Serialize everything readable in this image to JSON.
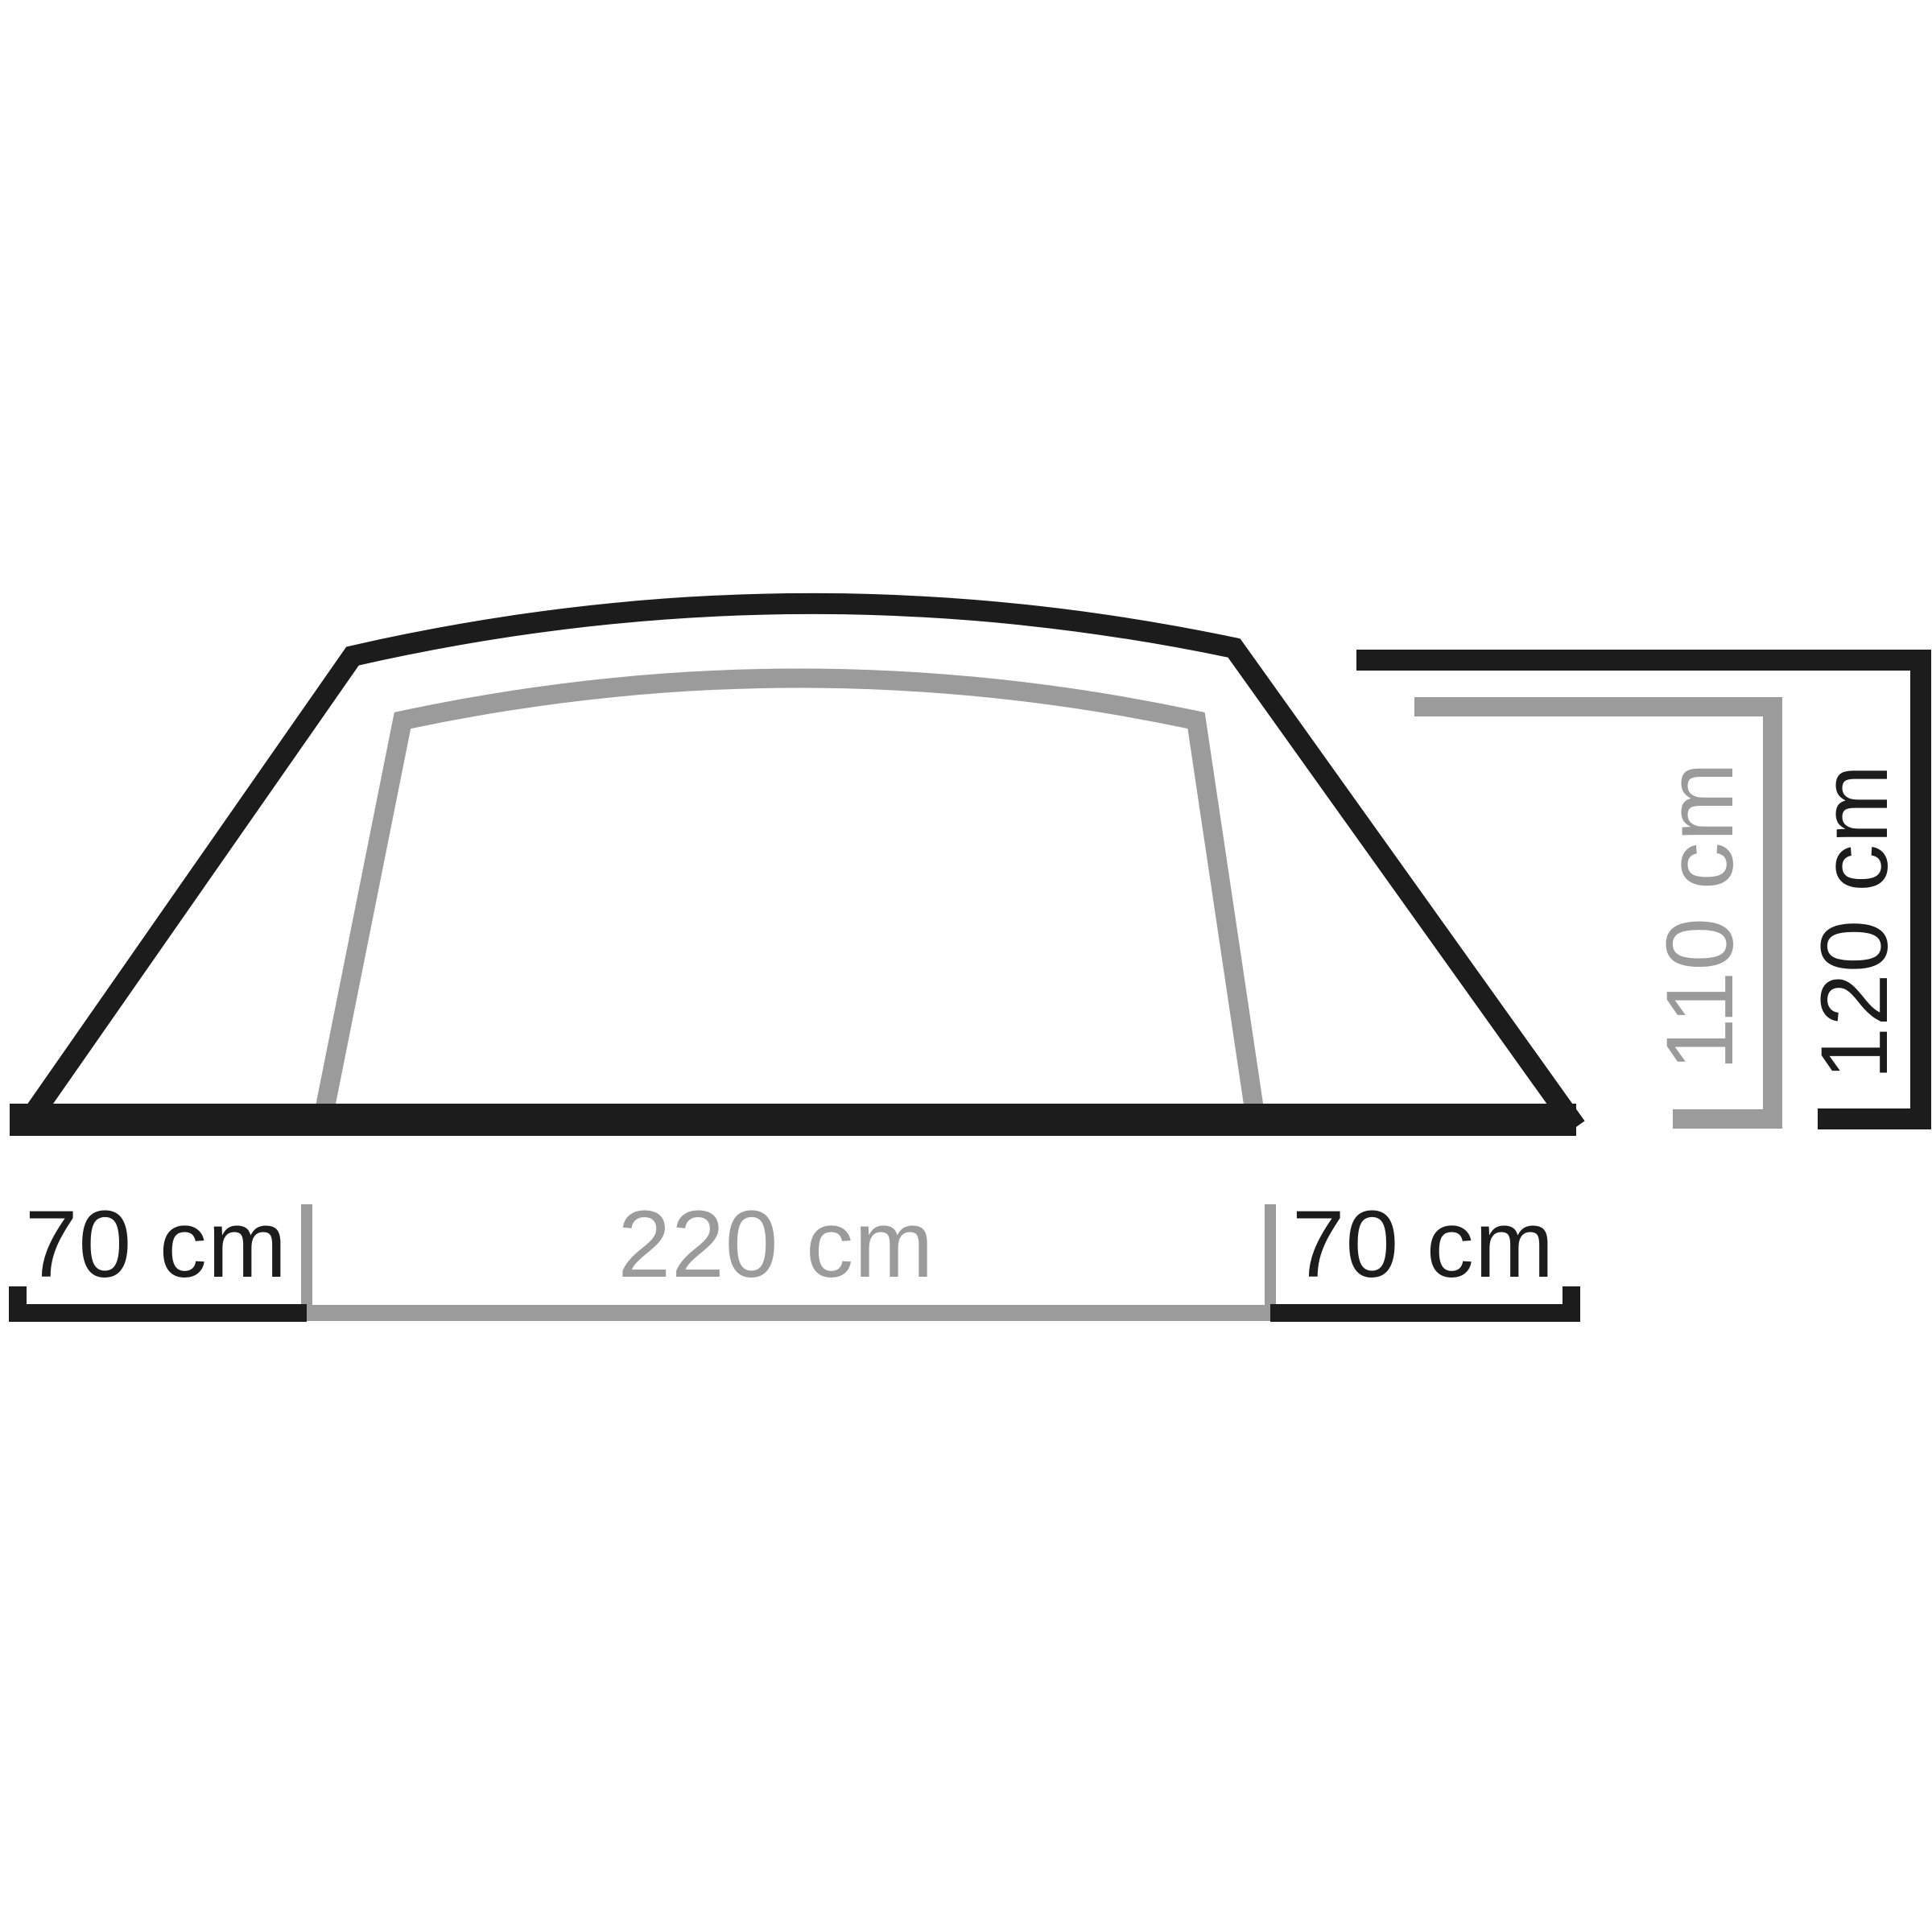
{
  "colors": {
    "outer": "#1c1c1c",
    "inner": "#9b9b9b",
    "background": "#ffffff"
  },
  "tent_profile": {
    "description": "tent-side-profile-dimension-diagram",
    "width_labels": [
      {
        "label": "70 cm"
      },
      {
        "label": "220 cm"
      },
      {
        "label": "70 cm"
      }
    ],
    "height_labels": [
      {
        "label": "110 cm"
      },
      {
        "label": "120 cm"
      }
    ]
  }
}
